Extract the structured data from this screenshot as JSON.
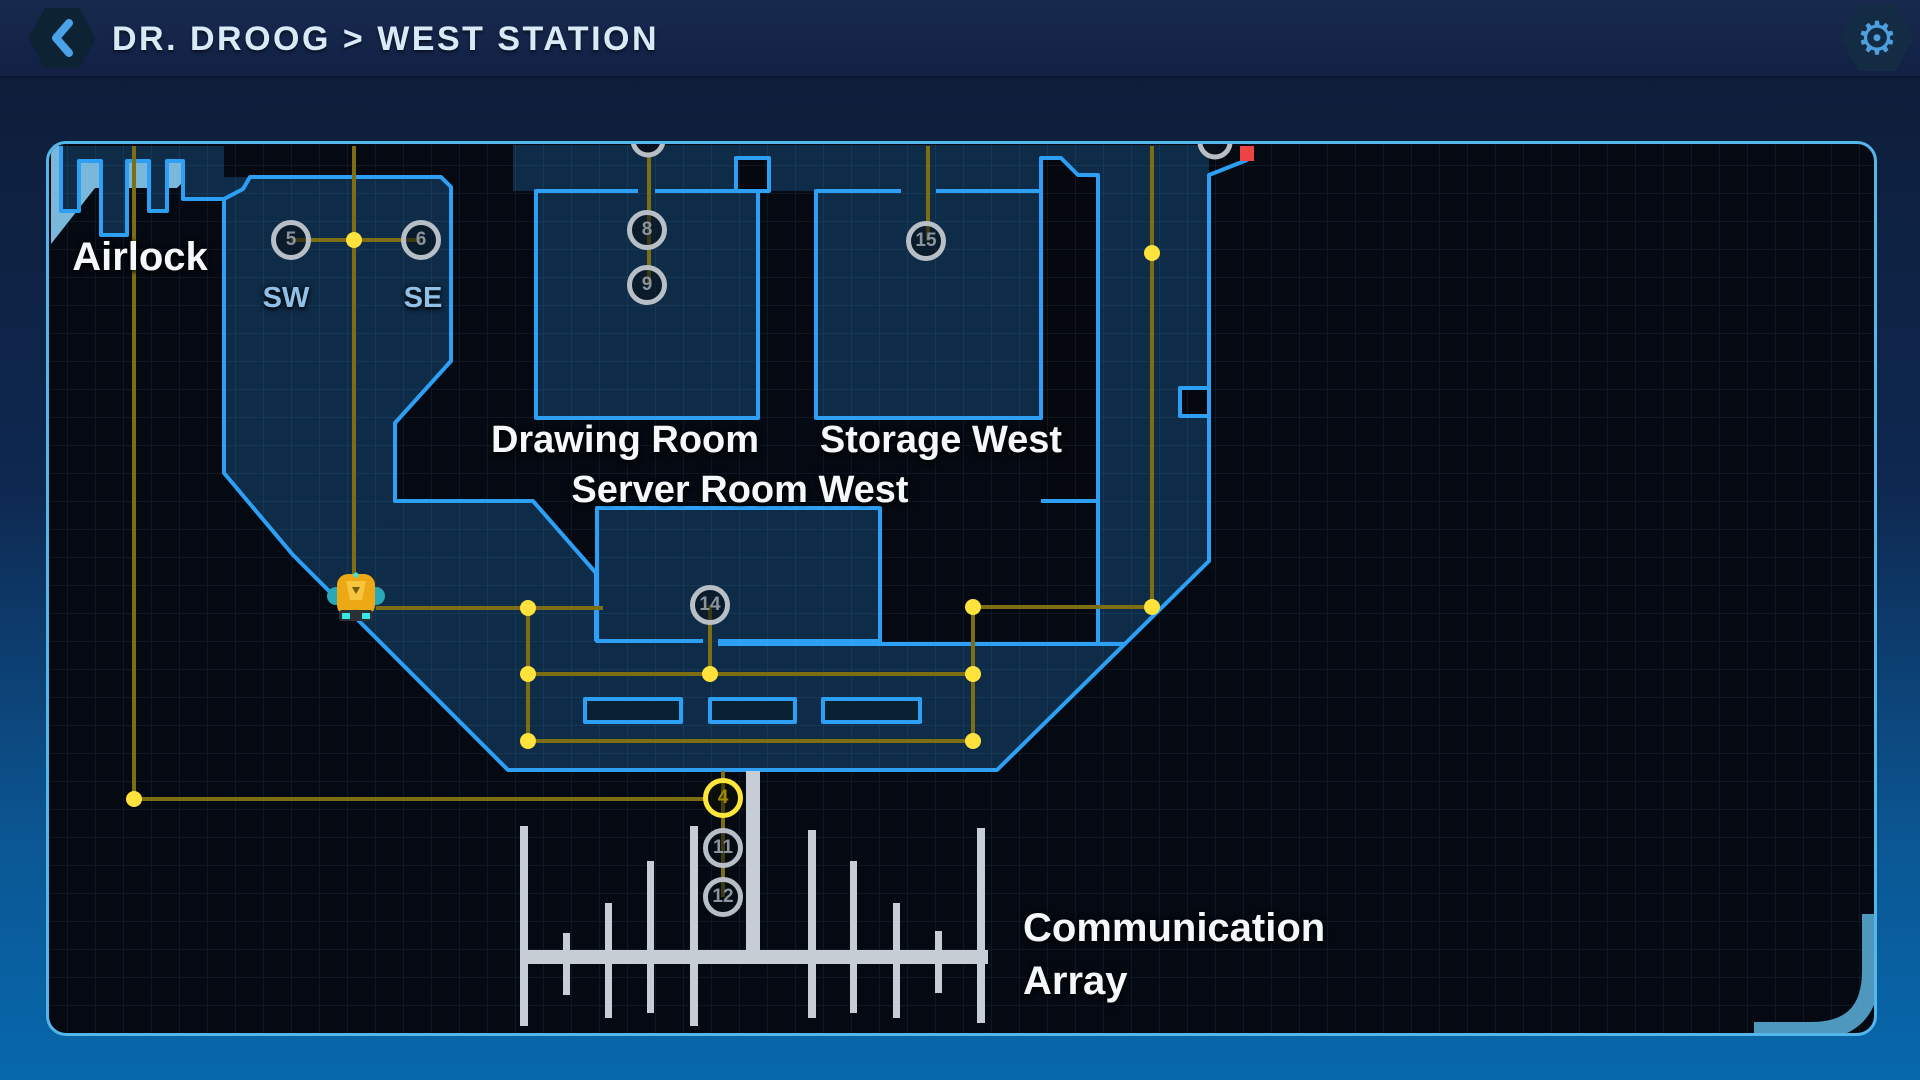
{
  "header": {
    "title": "DR. DROOG > WEST STATION",
    "back_icon": "chevron-left",
    "settings_icon": "gear"
  },
  "map": {
    "labels": {
      "airlock": "Airlock",
      "sw": "SW",
      "se": "SE",
      "drawing_room": "Drawing Room",
      "storage_west": "Storage West",
      "server_room_west": "Server Room West",
      "comm_line1": "Communication",
      "comm_line2": "Array"
    },
    "waypoints": [
      {
        "id": "5",
        "state": "default"
      },
      {
        "id": "6",
        "state": "default"
      },
      {
        "id": "8",
        "state": "default"
      },
      {
        "id": "9",
        "state": "default"
      },
      {
        "id": "15",
        "state": "default"
      },
      {
        "id": "14",
        "state": "default"
      },
      {
        "id": "4",
        "state": "selected"
      },
      {
        "id": "11",
        "state": "default"
      },
      {
        "id": "12",
        "state": "default"
      }
    ],
    "markers": {
      "robot": "rover-unit",
      "alert": "red-alert-marker"
    },
    "colors": {
      "wall": "#2da0f5",
      "floor": "#0e2c47",
      "path": "#7d6e13",
      "node_dot": "#ffe23c",
      "waypoint_ring": "#b8bec5",
      "waypoint_selected": "#ffe63a",
      "antenna": "#c7cdd4",
      "alert": "#ef4444",
      "panel_border": "#55b6ea"
    }
  }
}
